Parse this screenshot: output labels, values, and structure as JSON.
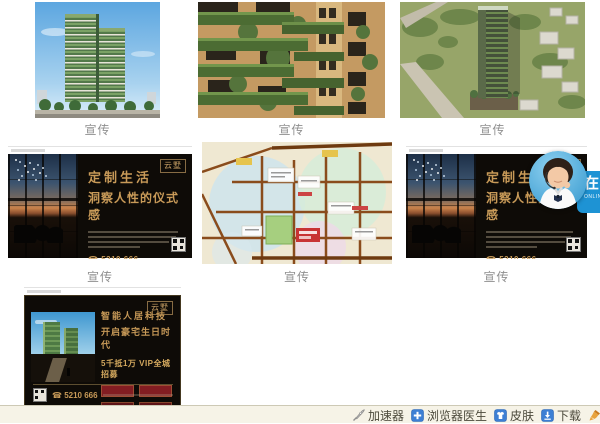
{
  "gallery": {
    "cards": [
      {
        "caption": "宣传"
      },
      {
        "caption": "宣传"
      },
      {
        "caption": "宣传"
      },
      {
        "caption": "宣传"
      },
      {
        "caption": "宣传"
      },
      {
        "caption": "宣传"
      },
      {
        "caption": ""
      }
    ]
  },
  "banner_custom_life": {
    "logo": "云墅",
    "title_line1": "定制生活",
    "title_line2": "洞察人性的仪式感",
    "phone_icon": "☎",
    "phone": "5210 666"
  },
  "banner_smart_living": {
    "logo": "云墅",
    "title_line1": "智能人居科技",
    "title_line2": "开启豪宅生日时代",
    "subtitle": "5千抵1万 VIP全城招募",
    "phone_icon": "☎",
    "phone": "5210 666"
  },
  "service_widget": {
    "tab_text": "在",
    "tab_subtext": "ONLINE"
  },
  "statusbar": {
    "items": [
      {
        "label": "加速器"
      },
      {
        "label": "浏览器医生"
      },
      {
        "label": "皮肤"
      },
      {
        "label": "下载"
      },
      {
        "label": "清除痕迹"
      }
    ]
  },
  "colors": {
    "accent_blue": "#1e93d4",
    "banner_gold": "#c89a58",
    "toolbar_icon_blue": "#3d7fd4",
    "toolbar_icon_orange": "#e09a2f",
    "caption_gray": "#8f8f8f"
  }
}
